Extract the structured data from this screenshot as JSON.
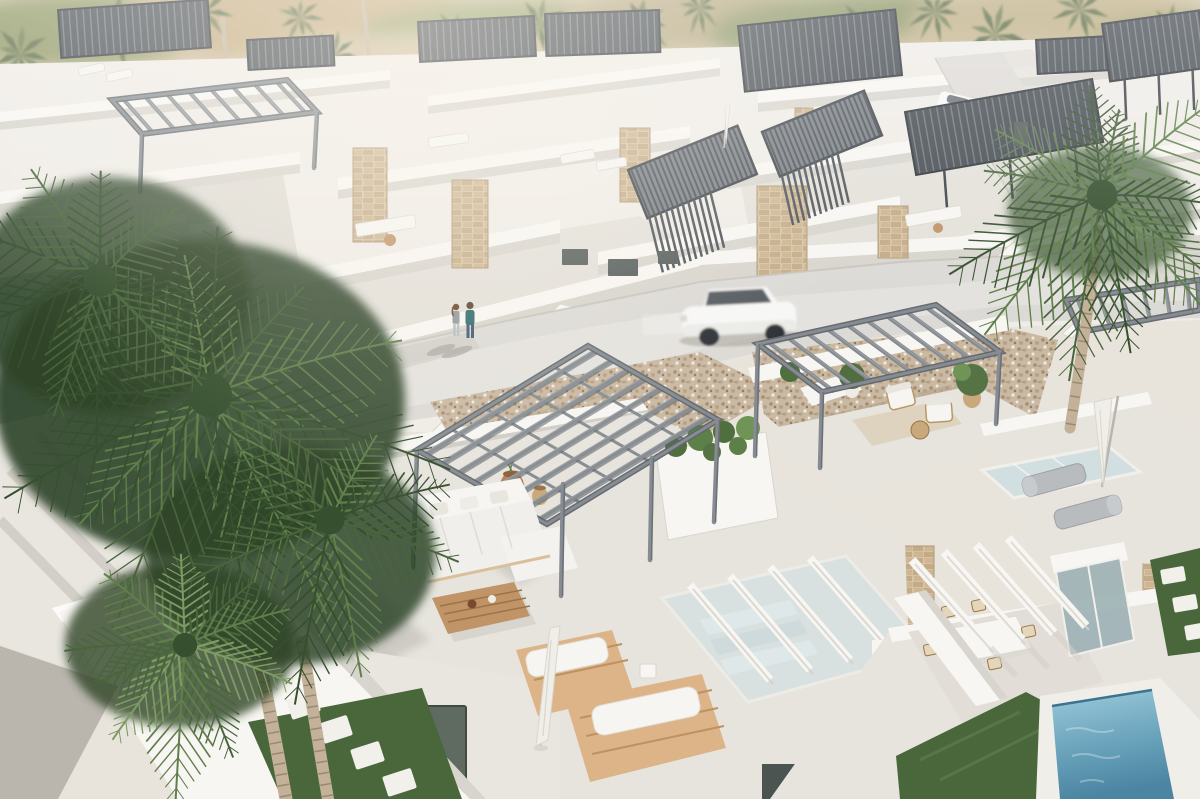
{
  "meta": {
    "type": "architectural-aerial-render",
    "description": "Aerial 3D rendering of a modern white Mediterranean villa development: rooftop terraces with steel pergolas and white outdoor furniture, dark louvre roofs, gravel courtyards, a curving road with a passing white SUV and a walking couple, stone-clad accent walls, a glass stair void, a small blue plunge pool, grass strips with stepping stones, and large palm trees in the foreground against a hazy hillside."
  },
  "palette": {
    "haze_base": "#cfc3a4",
    "wall_base": "#efece7",
    "wall_lit": "#f8f6f2",
    "wall_bright": "#fdfcfa",
    "wall_shade": "#d8d5ce",
    "wall_dark": "#c5c2ba",
    "floor": "#e7e4de",
    "floor_shadow": "#d0cdc6",
    "road": "#dcdad6",
    "road_bright": "#e6e4e0",
    "road_edge": "#c6c2bb",
    "gravel": "#c9b8a2",
    "gravel_dark": "#a58d71",
    "gravel_mid": "#b89f83",
    "gravel_light": "#efe9df",
    "steel": "#868c91",
    "steel_dark": "#5f656b",
    "steel_light": "#9da3a8",
    "slat_dark": "#464c52",
    "slat_line": "#798086",
    "slat_deep": "#30353b",
    "stone": "#d7c3a3",
    "stone_dark": "#c3ab88",
    "stone_line": "#b09878",
    "glass": "#cfdfe2",
    "glass_dark": "#9fb3b6",
    "wood": "#c09467",
    "wood_dark": "#9c7347",
    "deck": "#dcb487",
    "deck_line": "#bd9262",
    "sofa": "#f6f5f2",
    "sofa_shade": "#dedbd4",
    "lounger_gray": "#b9bcbe",
    "umbrella": "#f0eee8",
    "umbrella_shade": "#d9d6cd",
    "palm_dark": "#36502f",
    "palm_mid": "#49653c",
    "palm_light": "#5f7f4b",
    "palm_bright": "#7d9c63",
    "bg_palm": "#6e7d52",
    "bg_palm_dark": "#5c6b45",
    "canopy": "#2e4428",
    "trunk": "#c3b299",
    "trunk_ring": "#8f7f66",
    "grass": "#4a673c",
    "grass_light": "#5d7c49",
    "pool_light": "#9ccadb",
    "pool_dark": "#4c85a2",
    "pool_edge": "#3e7390",
    "car_white": "#f7f7f6",
    "car_window": "#474d54",
    "car_wheel": "#2e3338",
    "person_teal": "#2f6b6e",
    "person_jeans": "#41586f",
    "person_hair": "#6d4630",
    "person_top2": "#8f9b9a",
    "shadow": "#8d8a83",
    "paver": "#f2f0ea"
  },
  "hills": [
    {
      "cx": 80,
      "cy": 30,
      "rx": 130,
      "ry": 36,
      "fill": "#8e9764"
    },
    {
      "cx": 300,
      "cy": 20,
      "rx": 180,
      "ry": 40,
      "fill": "#c2a87c"
    },
    {
      "cx": 520,
      "cy": 35,
      "rx": 160,
      "ry": 34,
      "fill": "#96a06b"
    },
    {
      "cx": 700,
      "cy": 18,
      "rx": 140,
      "ry": 30,
      "fill": "#b3a67f"
    },
    {
      "cx": 880,
      "cy": 32,
      "rx": 170,
      "ry": 38,
      "fill": "#8a9464"
    },
    {
      "cx": 1060,
      "cy": 22,
      "rx": 150,
      "ry": 34,
      "fill": "#bfae85"
    },
    {
      "cx": 1180,
      "cy": 40,
      "rx": 90,
      "ry": 26,
      "fill": "#9aa06c"
    },
    {
      "cx": 430,
      "cy": 62,
      "rx": 200,
      "ry": 28,
      "fill": "#cdbd9b"
    },
    {
      "cx": 950,
      "cy": 62,
      "rx": 220,
      "ry": 28,
      "fill": "#c8b893"
    }
  ],
  "background_palms": [
    {
      "x": 20,
      "y": 55,
      "s": 1.0
    },
    {
      "x": 115,
      "y": 30,
      "s": 1.2
    },
    {
      "x": 205,
      "y": 12,
      "s": 0.9
    },
    {
      "x": 335,
      "y": 55,
      "s": 0.8
    },
    {
      "x": 300,
      "y": 18,
      "s": 0.7
    },
    {
      "x": 455,
      "y": 35,
      "s": 0.85
    },
    {
      "x": 540,
      "y": 25,
      "s": 0.95
    },
    {
      "x": 640,
      "y": 22,
      "s": 1.05
    },
    {
      "x": 700,
      "y": 8,
      "s": 0.7
    },
    {
      "x": 780,
      "y": 48,
      "s": 0.95
    },
    {
      "x": 860,
      "y": 25,
      "s": 0.75
    },
    {
      "x": 935,
      "y": 12,
      "s": 0.8
    },
    {
      "x": 995,
      "y": 35,
      "s": 1.0
    },
    {
      "x": 1080,
      "y": 10,
      "s": 0.85
    },
    {
      "x": 1170,
      "y": 30,
      "s": 0.9
    },
    {
      "x": 95,
      "y": 200,
      "s": 0.85
    },
    {
      "x": 470,
      "y": 120,
      "s": 0.55
    },
    {
      "x": 745,
      "y": 130,
      "s": 0.5
    }
  ],
  "villas": {
    "rows": [
      [
        0,
        112,
        390,
        70,
        10,
        8
      ],
      [
        428,
        96,
        720,
        58,
        10,
        8
      ],
      [
        758,
        92,
        1200,
        50,
        11,
        9
      ],
      [
        0,
        192,
        300,
        152,
        12,
        9
      ],
      [
        338,
        178,
        690,
        126,
        12,
        9
      ],
      [
        728,
        168,
        1060,
        118,
        12,
        9
      ],
      [
        1082,
        158,
        1200,
        140,
        11,
        8
      ],
      [
        0,
        294,
        255,
        254,
        13,
        10
      ],
      [
        298,
        272,
        560,
        220,
        13,
        10
      ],
      [
        598,
        252,
        900,
        196,
        13,
        10
      ],
      [
        938,
        240,
        1200,
        196,
        13,
        10
      ],
      [
        295,
        354,
        700,
        252,
        14,
        34
      ],
      [
        700,
        252,
        1200,
        222,
        13,
        30
      ]
    ],
    "courtyards": [
      {
        "pts": "0,200 280,158 300,268 0,294",
        "fill": "#dfdcd5"
      },
      {
        "pts": "320,270 640,216 700,252 340,354",
        "fill": "#e3e0da"
      },
      {
        "pts": "740,180 1050,130 1090,234 760,292",
        "fill": "#e4e1da"
      },
      {
        "pts": "0,312 175,296 178,432 0,432",
        "fill": "#ecebe6"
      }
    ],
    "cross": [
      "560,304 574,307 444,438 430,434",
      "905,334 1014,242 1026,246 917,338",
      "1062,334 1148,254 1158,258 1072,338",
      "175,432 58,304 70,302 187,430"
    ]
  },
  "stones": [
    [
      353,
      148,
      34,
      94
    ],
    [
      452,
      180,
      36,
      88
    ],
    [
      757,
      186,
      50,
      114
    ],
    [
      878,
      206,
      30,
      52
    ],
    [
      620,
      128,
      30,
      74
    ],
    [
      795,
      108,
      18,
      40
    ],
    [
      896,
      546,
      38,
      94
    ],
    [
      1150,
      464,
      50,
      100
    ],
    [
      1143,
      552,
      36,
      58
    ],
    [
      750,
      576,
      50,
      48
    ],
    [
      634,
      742,
      96,
      57
    ]
  ],
  "openings": [
    [
      562,
      249,
      26,
      16
    ],
    [
      608,
      259,
      30,
      17
    ],
    [
      658,
      251,
      20,
      13
    ],
    [
      1014,
      122,
      14,
      24
    ]
  ],
  "pergolas": {
    "dark": [
      {
        "x": 58,
        "y": 10,
        "w": 150,
        "h": 48,
        "rot": -4,
        "posts": 0
      },
      {
        "x": 247,
        "y": 40,
        "w": 86,
        "h": 30,
        "rot": -3,
        "posts": 0
      },
      {
        "x": 418,
        "y": 22,
        "w": 116,
        "h": 40,
        "rot": -3,
        "posts": 0
      },
      {
        "x": 545,
        "y": 14,
        "w": 114,
        "h": 42,
        "rot": -2,
        "posts": 0
      },
      {
        "x": 738,
        "y": 26,
        "w": 158,
        "h": 66,
        "rot": -6,
        "posts": 0
      },
      {
        "x": 1036,
        "y": 40,
        "w": 72,
        "h": 34,
        "rot": -3,
        "posts": 0
      },
      {
        "x": 1102,
        "y": 24,
        "w": 98,
        "h": 58,
        "rot": -8,
        "posts": 3
      },
      {
        "x": 905,
        "y": 112,
        "w": 190,
        "h": 64,
        "rot": -10,
        "posts": 3
      }
    ],
    "louvres": [
      {
        "x": 628,
        "y": 170,
        "w": 118,
        "h": 52,
        "rot": -22,
        "screenH": 56
      },
      {
        "x": 762,
        "y": 132,
        "w": 110,
        "h": 48,
        "rot": -22,
        "screenH": 50
      }
    ],
    "steel": [
      {
        "corners": [
          [
            112,
            100
          ],
          [
            287,
            80
          ],
          [
            317,
            112
          ],
          [
            142,
            134
          ]
        ],
        "beams": 8,
        "cross": 0,
        "posts": [
          [
            [
              142,
              134
            ],
            [
              140,
              192
            ]
          ],
          [
            [
              317,
              112
            ],
            [
              314,
              168
            ]
          ]
        ]
      },
      {
        "corners": [
          [
            588,
            346
          ],
          [
            718,
            420
          ],
          [
            547,
            524
          ],
          [
            417,
            450
          ]
        ],
        "beams": 8,
        "cross": 4,
        "posts": [
          [
            [
              417,
              450
            ],
            [
              413,
              568
            ]
          ],
          [
            [
              563,
              484
            ],
            [
              561,
              596
            ]
          ],
          [
            [
              718,
              420
            ],
            [
              714,
              522
            ]
          ],
          [
            [
              652,
              458
            ],
            [
              650,
              560
            ]
          ]
        ]
      },
      {
        "corners": [
          [
            758,
            344
          ],
          [
            936,
            305
          ],
          [
            1000,
            352
          ],
          [
            822,
            392
          ]
        ],
        "beams": 9,
        "cross": 0,
        "posts": [
          [
            [
              758,
              344
            ],
            [
              755,
              456
            ]
          ],
          [
            [
              822,
              392
            ],
            [
              820,
              468
            ]
          ],
          [
            [
              1000,
              352
            ],
            [
              996,
              424
            ]
          ]
        ]
      },
      {
        "corners": [
          [
            1066,
            300
          ],
          [
            1198,
            280
          ],
          [
            1200,
            310
          ],
          [
            1080,
            332
          ]
        ],
        "beams": 6,
        "cross": 0,
        "posts": [
          [
            [
              1080,
              332
            ],
            [
              1078,
              380
            ]
          ]
        ]
      }
    ]
  },
  "court_furniture": {
    "white_pieces": [
      [
        78,
        68,
        26,
        8,
        -12
      ],
      [
        106,
        74,
        26,
        8,
        -12
      ],
      [
        152,
        218,
        34,
        10,
        -9
      ],
      [
        188,
        225,
        30,
        10,
        -9
      ],
      [
        355,
        224,
        60,
        13,
        -9
      ],
      [
        560,
        155,
        34,
        9,
        -10
      ],
      [
        596,
        162,
        30,
        9,
        -10
      ],
      [
        905,
        215,
        56,
        12,
        -10
      ],
      [
        428,
        138,
        40,
        10,
        -8
      ]
    ],
    "tables": [
      [
        390,
        240,
        6
      ],
      [
        938,
        228,
        5
      ]
    ],
    "closed_parasols": [
      [
        727,
        106,
        42
      ],
      [
        990,
        296,
        56
      ],
      [
        575,
        326,
        40
      ]
    ]
  },
  "palms": {
    "trunks": [
      {
        "pts": [
          258,
          652,
          272,
          722,
          286,
          799
        ],
        "w": 13
      },
      {
        "pts": [
          302,
          642,
          314,
          718,
          328,
          799
        ],
        "w": 12
      },
      {
        "pts": [
          1098,
          230,
          1086,
          330,
          1070,
          428
        ],
        "w": 11
      },
      {
        "pts": [
          222,
          12,
          228,
          80,
          232,
          142
        ],
        "w": 5
      },
      {
        "pts": [
          363,
          2,
          367,
          32,
          369,
          58
        ],
        "w": 4
      },
      {
        "pts": [
          652,
          28,
          657,
          80,
          661,
          130
        ],
        "w": 5
      },
      {
        "pts": [
          783,
          54,
          788,
          110,
          792,
          160
        ],
        "w": 5
      },
      {
        "pts": [
          28,
          62,
          33,
          120,
          37,
          182
        ],
        "w": 6
      },
      {
        "pts": [
          97,
          207,
          100,
          255,
          103,
          300
        ],
        "w": 6
      }
    ],
    "crowns": [
      {
        "target": "g-left-palm",
        "cx": 210,
        "cy": 395,
        "n": 13,
        "lmin": 150,
        "lmax": 245,
        "colors": [
          "palm_dark",
          "palm_mid",
          "palm_light"
        ]
      },
      {
        "target": "g-left-palm",
        "cx": 100,
        "cy": 280,
        "n": 9,
        "lmin": 120,
        "lmax": 185,
        "colors": [
          "palm_dark",
          "palm_mid"
        ]
      },
      {
        "target": "g-left-palm",
        "cx": 330,
        "cy": 520,
        "n": 8,
        "lmin": 100,
        "lmax": 160,
        "colors": [
          "palm_dark",
          "palm_mid",
          "palm_light"
        ]
      },
      {
        "target": "g-left-palm",
        "cx": 185,
        "cy": 645,
        "n": 10,
        "lmin": 85,
        "lmax": 135,
        "colors": [
          "palm_mid",
          "palm_light",
          "palm_bright"
        ]
      },
      {
        "target": "g-right-palm",
        "cx": 1102,
        "cy": 195,
        "n": 12,
        "lmin": 105,
        "lmax": 170,
        "colors": [
          "palm_mid",
          "palm_light",
          "palm_dark"
        ]
      }
    ]
  },
  "pavers": {
    "left": [
      [
        286,
        700,
        -18
      ],
      [
        318,
        724,
        -18
      ],
      [
        350,
        750,
        -18
      ],
      [
        382,
        777,
        -18
      ]
    ],
    "left_size": [
      30,
      21
    ],
    "right": [
      [
        1160,
        570,
        -10
      ],
      [
        1172,
        598,
        -10
      ],
      [
        1184,
        626,
        -10
      ]
    ],
    "right_size": [
      24,
      15
    ]
  },
  "road": {
    "moving_car": {
      "x": 740,
      "y": 314,
      "rot": -3
    },
    "parked_car": {
      "x": 958,
      "y": 104,
      "rot": 14
    },
    "people": {
      "woman": {
        "x": 456,
        "y": 308
      },
      "man": {
        "x": 470,
        "y": 306
      }
    }
  }
}
